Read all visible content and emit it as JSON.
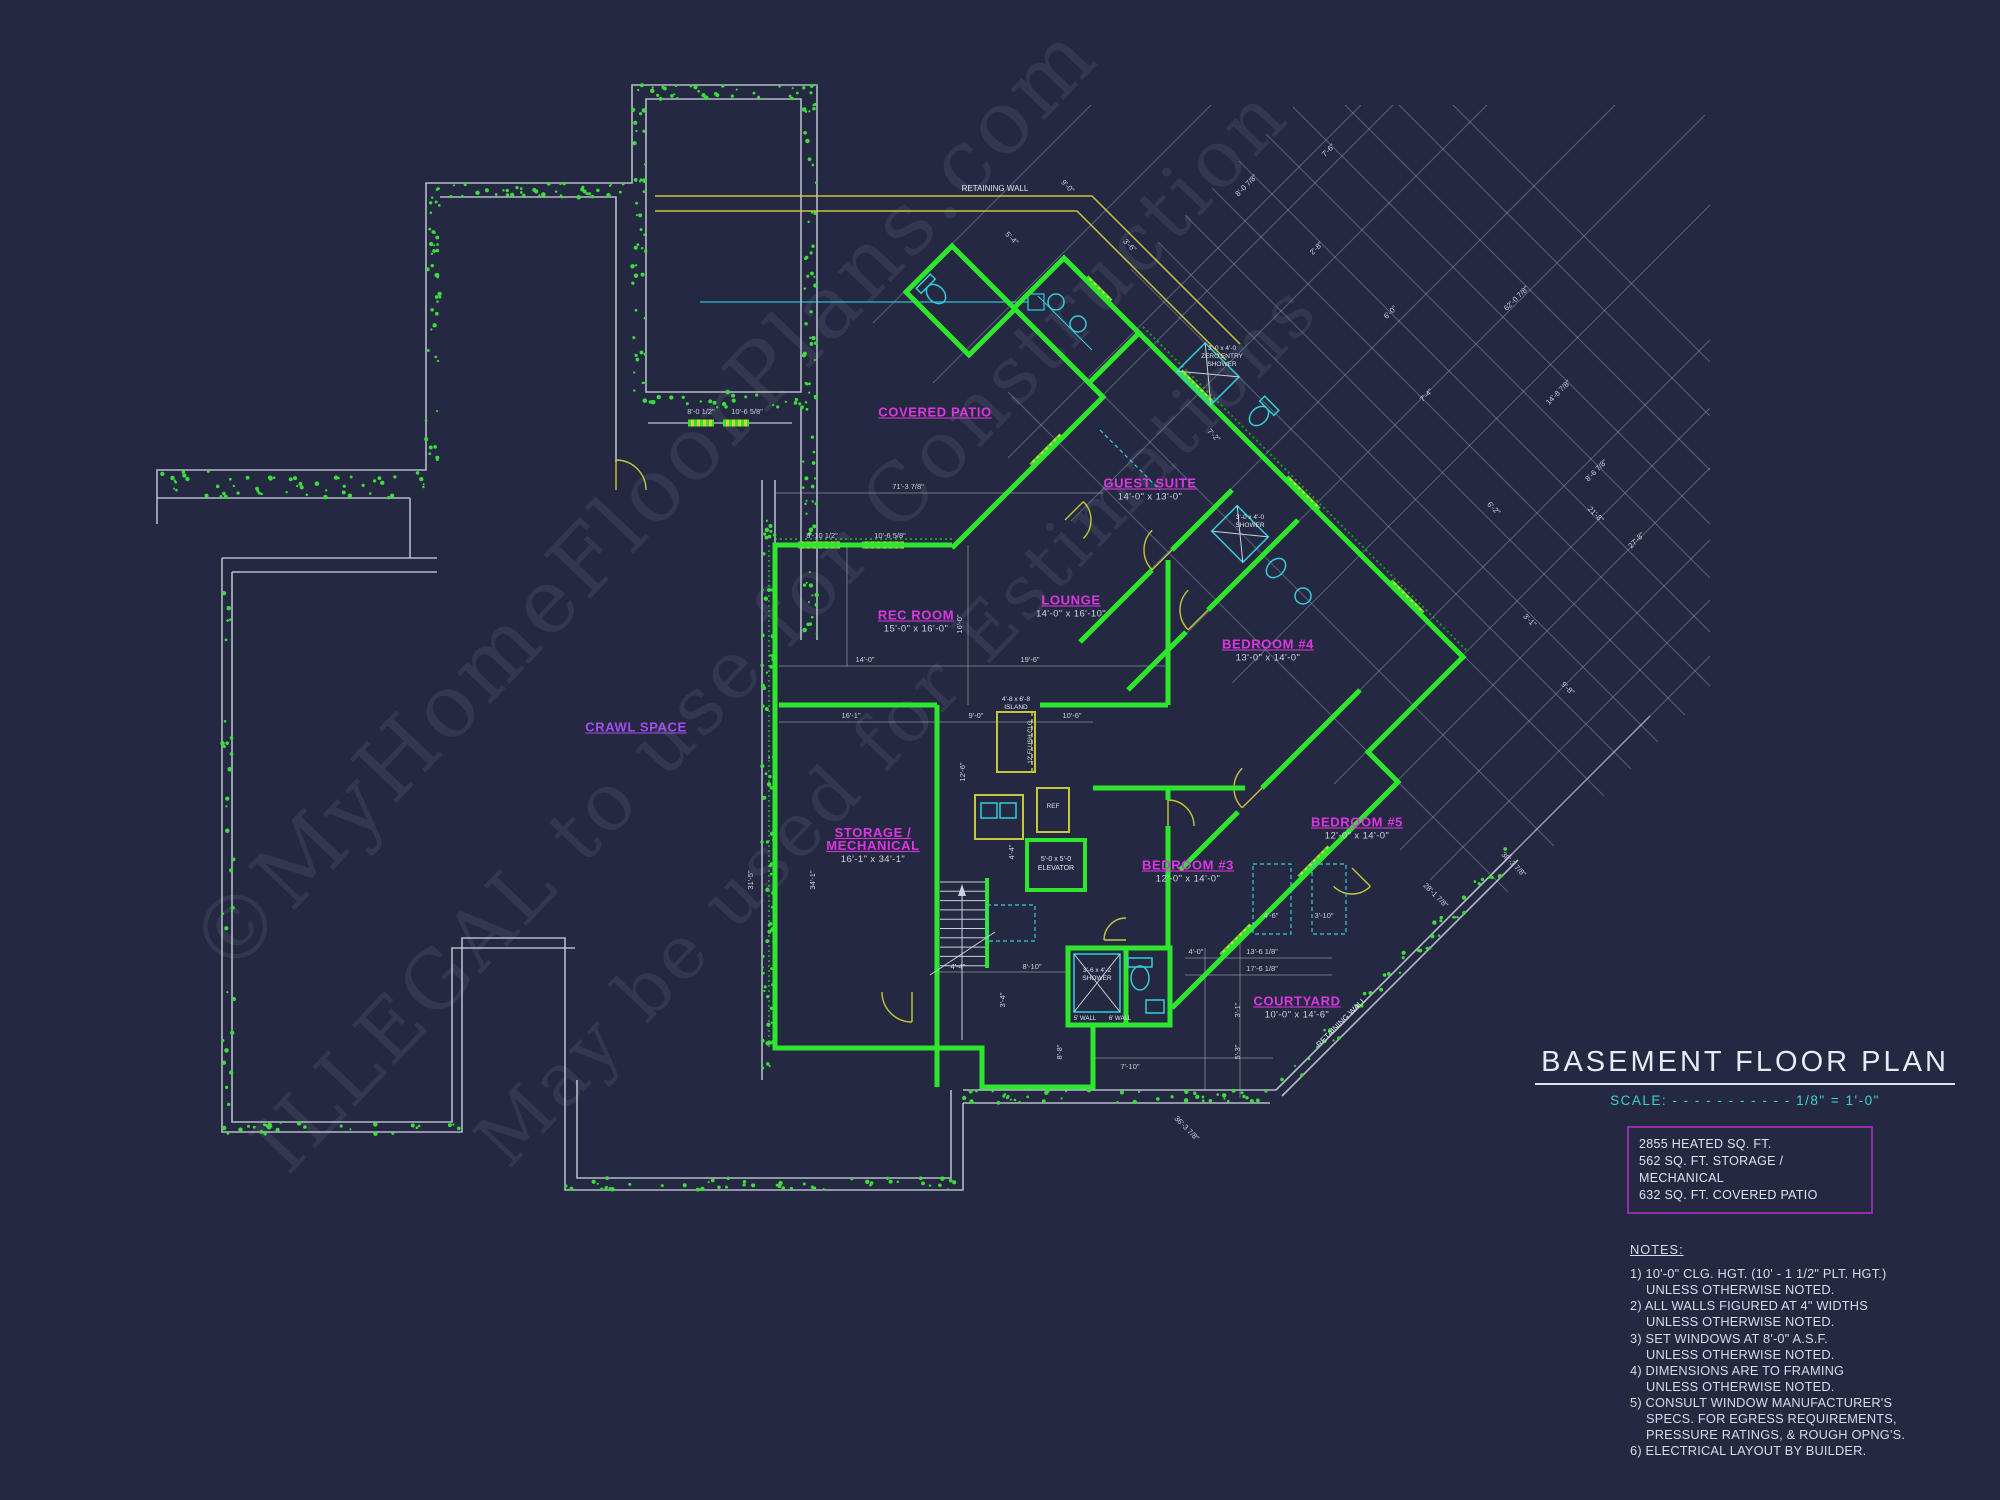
{
  "colors": {
    "background": "#242941",
    "wall_green": "#2fe62f",
    "outline_white": "#c4cad9",
    "retaining_yellow": "#c6c63e",
    "fixture_cyan": "#35ccdc",
    "label_magenta": "#de35e3",
    "crawl_purple": "#a64cf0",
    "scale_cyan": "#3ed2cd",
    "area_box_border": "#8d2fae",
    "watermark": "#98a1c0"
  },
  "title_block": {
    "title": "BASEMENT FLOOR PLAN",
    "scale_prefix": "SCALE:",
    "scale_dashes": "- - - - - - - - - - -",
    "scale_value": "1/8\" = 1'-0\""
  },
  "area_box": {
    "lines": [
      "2855 HEATED SQ. FT.",
      "562 SQ. FT. STORAGE / MECHANICAL",
      "632 SQ. FT. COVERED PATIO"
    ]
  },
  "notes": {
    "heading": "NOTES:",
    "items": [
      {
        "t": "1) 10'-0\"  CLG. HGT. (10' - 1 1/2\" PLT. HGT.)",
        "i": 0
      },
      {
        "t": "UNLESS OTHERWISE NOTED.",
        "i": 1
      },
      {
        "t": "2) ALL WALLS FIGURED AT 4\" WIDTHS",
        "i": 0
      },
      {
        "t": "UNLESS OTHERWISE NOTED.",
        "i": 1
      },
      {
        "t": "3) SET WINDOWS AT 8'-0\" A.S.F.",
        "i": 0
      },
      {
        "t": "UNLESS OTHERWISE NOTED.",
        "i": 1
      },
      {
        "t": "4) DIMENSIONS ARE TO FRAMING",
        "i": 0
      },
      {
        "t": "UNLESS OTHERWISE NOTED.",
        "i": 1
      },
      {
        "t": "5) CONSULT WINDOW MANUFACTURER'S",
        "i": 0
      },
      {
        "t": "SPECS. FOR EGRESS REQUIREMENTS,",
        "i": 1
      },
      {
        "t": "PRESSURE RATINGS, & ROUGH OPNG'S.",
        "i": 1
      },
      {
        "t": "6) ELECTRICAL LAYOUT BY BUILDER.",
        "i": 0
      }
    ]
  },
  "rooms": [
    {
      "name": "covered-patio",
      "label": "COVERED PATIO",
      "dims": "",
      "x": 935,
      "y": 412
    },
    {
      "name": "guest-suite",
      "label": "GUEST SUITE",
      "dims": "14'-0\" x 13'-0\"",
      "x": 1150,
      "y": 489
    },
    {
      "name": "rec-room",
      "label": "REC ROOM",
      "dims": "15'-0\" x 16'-0\"",
      "x": 916,
      "y": 621
    },
    {
      "name": "lounge",
      "label": "LOUNGE",
      "dims": "14'-0\" x 16'-10\"",
      "x": 1071,
      "y": 606
    },
    {
      "name": "bedroom-4",
      "label": "BEDROOM #4",
      "dims": "13'-0\" x 14'-0\"",
      "x": 1268,
      "y": 650
    },
    {
      "name": "crawl-space",
      "label": "CRAWL SPACE",
      "dims": "",
      "x": 636,
      "y": 727,
      "crawl": true
    },
    {
      "name": "storage-mechanical",
      "label": "STORAGE /",
      "label2": "MECHANICAL",
      "dims": "16'-1\" x 34'-1\"",
      "x": 873,
      "y": 845
    },
    {
      "name": "bedroom-5",
      "label": "BEDROOM #5",
      "dims": "12'-0\" x 14'-0\"",
      "x": 1357,
      "y": 828
    },
    {
      "name": "bedroom-3",
      "label": "BEDROOM #3",
      "dims": "12'-0\" x 14'-0\"",
      "x": 1188,
      "y": 871
    },
    {
      "name": "courtyard",
      "label": "COURTYARD",
      "dims": "10'-0\" x 14'-6\"",
      "x": 1297,
      "y": 1007
    }
  ],
  "annotations": [
    {
      "text": "RETAINING WALL",
      "x": 995,
      "y": 191,
      "rot": 0,
      "size": 8
    },
    {
      "text": "RETAINING WALL",
      "x": 1343,
      "y": 1024,
      "rot": -45,
      "size": 8
    },
    {
      "text": "5'-0 x 5'-0",
      "x": 1056,
      "y": 861,
      "rot": 0,
      "size": 7
    },
    {
      "text": "ELEVATOR",
      "x": 1056,
      "y": 870,
      "rot": 0,
      "size": 7
    },
    {
      "text": "3'-0 x 4'-0",
      "x": 1222,
      "y": 350,
      "rot": 0,
      "size": 6.5
    },
    {
      "text": "ZERO ENTRY",
      "x": 1222,
      "y": 358,
      "rot": 0,
      "size": 6.5
    },
    {
      "text": "SHOWER",
      "x": 1222,
      "y": 366,
      "rot": 0,
      "size": 6.5
    },
    {
      "text": "3'-0 x 4'-0",
      "x": 1250,
      "y": 519,
      "rot": 0,
      "size": 6.5
    },
    {
      "text": "SHOWER",
      "x": 1250,
      "y": 527,
      "rot": 0,
      "size": 6.5
    },
    {
      "text": "3'-6 x 4'-2",
      "x": 1097,
      "y": 972,
      "rot": 0,
      "size": 6.5
    },
    {
      "text": "SHOWER",
      "x": 1097,
      "y": 980,
      "rot": 0,
      "size": 6.5
    },
    {
      "text": "5' WALL",
      "x": 1085,
      "y": 1020,
      "rot": 0,
      "size": 6
    },
    {
      "text": "6' WALL",
      "x": 1120,
      "y": 1020,
      "rot": 0,
      "size": 6
    },
    {
      "text": "4'-8 x 6'-8",
      "x": 1016,
      "y": 701,
      "rot": 0,
      "size": 6.5
    },
    {
      "text": "ISLAND",
      "x": 1016,
      "y": 709,
      "rot": 0,
      "size": 6.5
    },
    {
      "text": "REF",
      "x": 1053,
      "y": 808,
      "rot": 0,
      "size": 6.5
    },
    {
      "text": "12' FLUSH CLG",
      "x": 1032,
      "y": 742,
      "rot": -90,
      "size": 6
    }
  ],
  "dimensions": [
    {
      "t": "71'-3 7/8\"",
      "x": 908,
      "y": 489,
      "r": 0
    },
    {
      "t": "8'-0 1/2\"",
      "x": 701,
      "y": 414,
      "r": 0
    },
    {
      "t": "10'-6 5/8\"",
      "x": 747,
      "y": 414,
      "r": 0
    },
    {
      "t": "8'-10 1/2\"",
      "x": 822,
      "y": 538,
      "r": 0
    },
    {
      "t": "10'-6 5/8\"",
      "x": 890,
      "y": 538,
      "r": 0
    },
    {
      "t": "14'-0\"",
      "x": 865,
      "y": 662,
      "r": 0
    },
    {
      "t": "19'-6\"",
      "x": 1030,
      "y": 662,
      "r": 0
    },
    {
      "t": "16'-0\"",
      "x": 962,
      "y": 624,
      "r": -90
    },
    {
      "t": "16'-1\"",
      "x": 851,
      "y": 718,
      "r": 0
    },
    {
      "t": "9'-0\"",
      "x": 976,
      "y": 718,
      "r": 0
    },
    {
      "t": "10'-6\"",
      "x": 1072,
      "y": 718,
      "r": 0
    },
    {
      "t": "31'-5\"",
      "x": 753,
      "y": 880,
      "r": -90
    },
    {
      "t": "34'-1\"",
      "x": 815,
      "y": 880,
      "r": -90
    },
    {
      "t": "12'-6\"",
      "x": 965,
      "y": 772,
      "r": -90
    },
    {
      "t": "4'-4\"",
      "x": 958,
      "y": 969,
      "r": 0
    },
    {
      "t": "8'-10\"",
      "x": 1032,
      "y": 969,
      "r": 0
    },
    {
      "t": "4'-4\"",
      "x": 1014,
      "y": 852,
      "r": -90
    },
    {
      "t": "7'-10\"",
      "x": 1130,
      "y": 1069,
      "r": 0
    },
    {
      "t": "3'-4\"",
      "x": 1005,
      "y": 1000,
      "r": -90
    },
    {
      "t": "8'-8\"",
      "x": 1062,
      "y": 1052,
      "r": -90
    },
    {
      "t": "13'-6 1/8\"",
      "x": 1262,
      "y": 954,
      "r": 0
    },
    {
      "t": "17'-6 1/8\"",
      "x": 1262,
      "y": 971,
      "r": 0
    },
    {
      "t": "4'-0\"",
      "x": 1196,
      "y": 954,
      "r": 0
    },
    {
      "t": "4'-6\"",
      "x": 1271,
      "y": 918,
      "r": 0
    },
    {
      "t": "3'-10\"",
      "x": 1324,
      "y": 918,
      "r": 0
    },
    {
      "t": "3'-1\"",
      "x": 1240,
      "y": 1010,
      "r": -90
    },
    {
      "t": "5'-3\"",
      "x": 1240,
      "y": 1052,
      "r": -90
    },
    {
      "t": "7'-2\"",
      "x": 1212,
      "y": 437,
      "r": 45
    },
    {
      "t": "3'-6\"",
      "x": 1128,
      "y": 247,
      "r": 45
    },
    {
      "t": "9'-0\"",
      "x": 1066,
      "y": 188,
      "r": 45
    },
    {
      "t": "5'-4\"",
      "x": 1010,
      "y": 240,
      "r": 45
    },
    {
      "t": "8'-0 7/8\"",
      "x": 1248,
      "y": 187,
      "r": -45
    },
    {
      "t": "7'-6\"",
      "x": 1330,
      "y": 152,
      "r": -45
    },
    {
      "t": "2'-8\"",
      "x": 1318,
      "y": 250,
      "r": -45
    },
    {
      "t": "6'-0\"",
      "x": 1392,
      "y": 314,
      "r": -45
    },
    {
      "t": "7'-4\"",
      "x": 1428,
      "y": 397,
      "r": -45
    },
    {
      "t": "62'-0 7/8\"",
      "x": 1518,
      "y": 300,
      "r": -45
    },
    {
      "t": "14'-8 7/8\"",
      "x": 1560,
      "y": 394,
      "r": -45
    },
    {
      "t": "8'-6 7/8\"",
      "x": 1598,
      "y": 472,
      "r": -45
    },
    {
      "t": "27'-8\"",
      "x": 1638,
      "y": 542,
      "r": -45
    },
    {
      "t": "6'-2\"",
      "x": 1492,
      "y": 510,
      "r": 45
    },
    {
      "t": "3'-1\"",
      "x": 1528,
      "y": 622,
      "r": 45
    },
    {
      "t": "9'-8\"",
      "x": 1566,
      "y": 690,
      "r": 45
    },
    {
      "t": "21'-8\"",
      "x": 1594,
      "y": 516,
      "r": 45
    },
    {
      "t": "38'-3 7/8\"",
      "x": 1512,
      "y": 866,
      "r": 45
    },
    {
      "t": "28'-1 7/8\"",
      "x": 1434,
      "y": 897,
      "r": 45
    },
    {
      "t": "36'-3 7/8\"",
      "x": 1185,
      "y": 1130,
      "r": 45
    }
  ],
  "watermark": [
    {
      "text": "©MyHomeFloorPlans.com",
      "x": 665,
      "y": 520,
      "size": 88
    },
    {
      "text": "ILLEGAL to use for Construction",
      "x": 790,
      "y": 648,
      "size": 80
    },
    {
      "text": "May be used for Estimations",
      "x": 915,
      "y": 742,
      "size": 74
    }
  ]
}
